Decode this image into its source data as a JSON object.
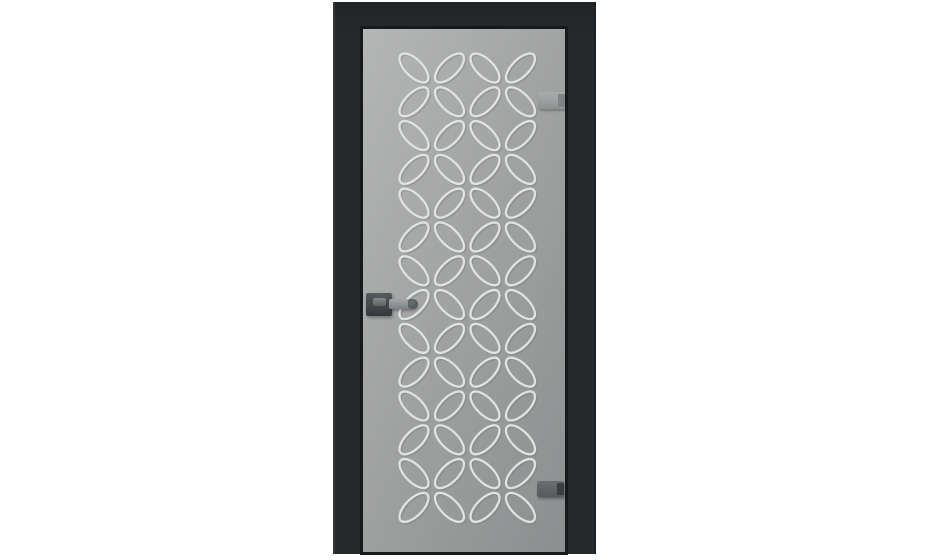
{
  "scene": {
    "description": "Product photo of a frosted-glass interior door in a black frame, glass decorated with an embossed lattice of tilted ellipses forming four-petal flower motifs; lever handle on the left edge, two hinges on the right edge, plain white background",
    "background_color": "#ffffff"
  },
  "door": {
    "frame": {
      "color": "#272a2c",
      "top_color": "#222527",
      "highlight_color": "#35383a",
      "shadow_color": "#1d2022",
      "glass_seam_color": "#17191b"
    },
    "glass": {
      "gradient_start": "#b5b6b6",
      "gradient_mid": "#a2a3a3",
      "gradient_end": "#8c8e8f"
    },
    "pattern": {
      "motif": "four-petal ellipse flowers",
      "stroke_color": "#e7e9e8",
      "shadow_color": "#6f7273",
      "stroke_width": 2.3,
      "col_centers": [
        51,
        86.5,
        122,
        157.5
      ],
      "row_start": 39,
      "row_spacing": 33.8,
      "row_count": 14,
      "ellipse_rx": 8.6,
      "ellipse_ry": 18.6,
      "tilt_deg": 45
    },
    "hardware": {
      "handle_plate_color_top": "#565b5e",
      "handle_plate_color_bottom": "#34383a",
      "handle_lever_color_top": "#a2a8a8",
      "handle_lever_color_bottom": "#7c8283",
      "handle_tip_color": "#4a4f51",
      "hinge_top_color_top": "#aaadad",
      "hinge_top_color_bottom": "#8e9191",
      "hinge_top_cap_color": "#808384",
      "hinge_bottom_color_top": "#6b6e70",
      "hinge_bottom_color_bottom": "#565a5c",
      "hinge_bottom_cap_color": "#3b3e40"
    }
  }
}
